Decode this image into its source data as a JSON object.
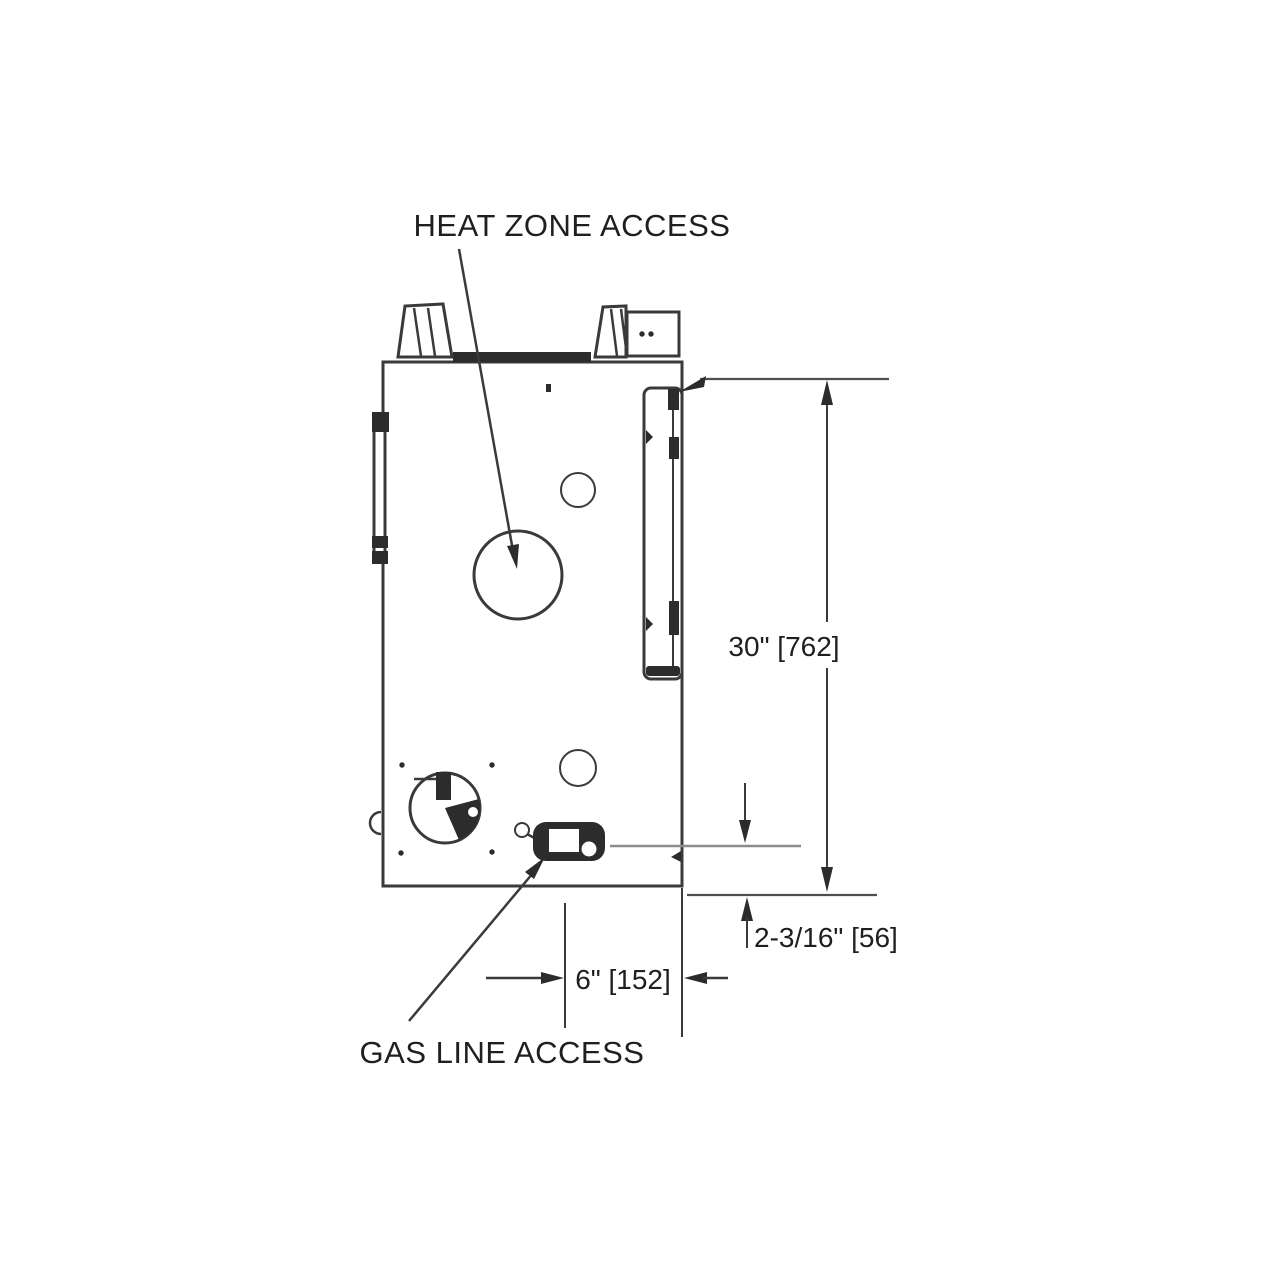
{
  "diagram": {
    "labels": {
      "heat_zone_access": "HEAT ZONE ACCESS",
      "gas_line_access": "GAS LINE ACCESS"
    },
    "dimensions": {
      "height": "30\" [762]",
      "bottom_offset": "2-3/16\" [56]",
      "gas_line_offset": "6\" [152]"
    },
    "colors": {
      "background": "#ffffff",
      "line": "#3a3a3a",
      "dim_line": "#4f4f4f",
      "light_line": "#8c8c8c",
      "text": "#1f1f1f"
    }
  }
}
